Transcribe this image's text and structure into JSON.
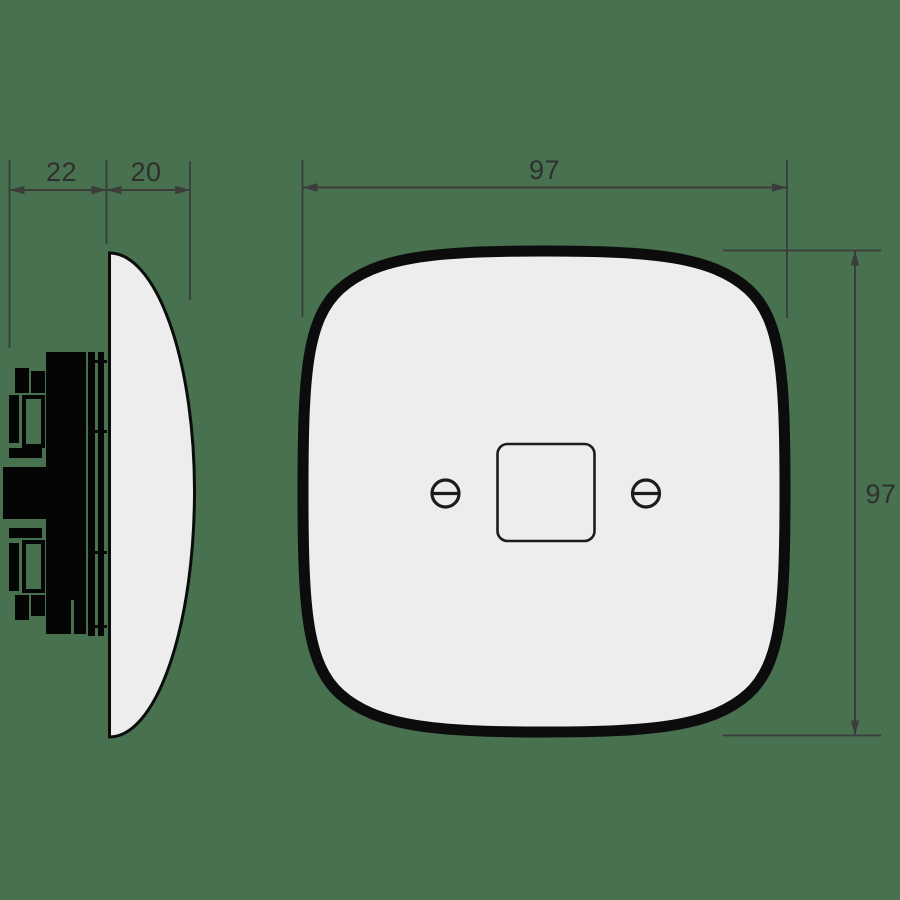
{
  "colors": {
    "background": "#47714F",
    "product_fill": "#EDEDED",
    "product_outline": "#0C0C0C",
    "silhouette_fill": "#050505",
    "detail_line": "#1C1C1C",
    "dimension_line": "#3C3C3C",
    "dimension_text": "#2F2F2F"
  },
  "dimensions": {
    "side_rear_depth": {
      "value": "22"
    },
    "side_front_depth": {
      "value": "20"
    },
    "front_width": {
      "value": "97"
    },
    "front_height": {
      "value": "97"
    }
  }
}
